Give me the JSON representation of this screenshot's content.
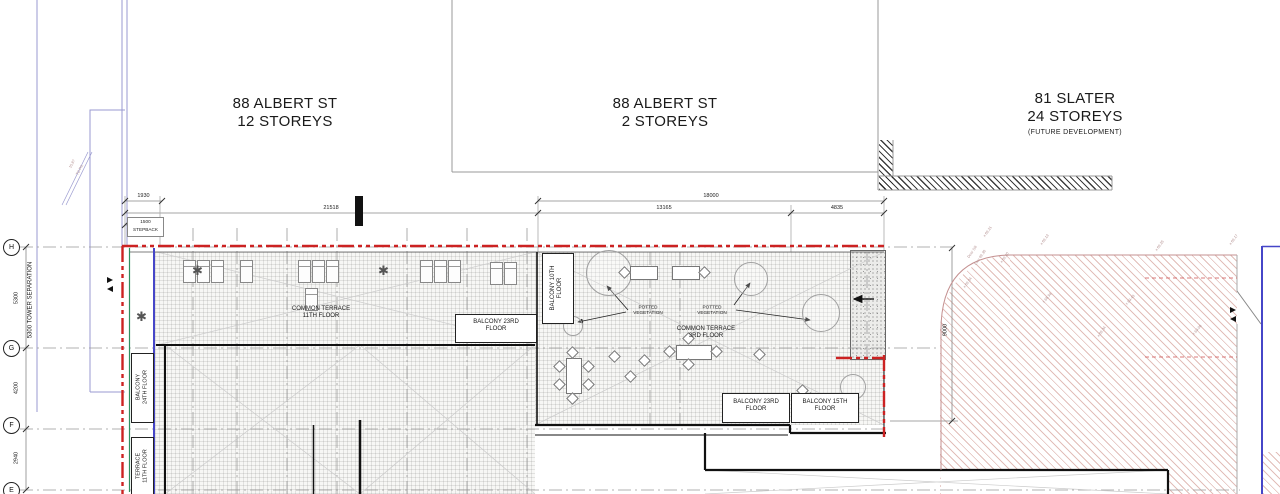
{
  "colors": {
    "red_boundary": "#cc2222",
    "green_line": "#2e9060",
    "blue_line": "#4646c8",
    "purple_line": "#9a9ad0",
    "hatch_pink": "#c49090"
  },
  "parcels": [
    {
      "title": "88 ALBERT ST",
      "subtitle": "12 STOREYS",
      "note": ""
    },
    {
      "title": "88 ALBERT ST",
      "subtitle": "2 STOREYS",
      "note": ""
    },
    {
      "title": "81 SLATER",
      "subtitle": "24 STOREYS",
      "note": "(FUTURE DEVELOPMENT)"
    }
  ],
  "grid_rows": [
    {
      "label": "H",
      "dim_below": "5300"
    },
    {
      "label": "G",
      "dim_below": "4200"
    },
    {
      "label": "F",
      "dim_below": "2940"
    },
    {
      "label": "E",
      "dim_below": ""
    }
  ],
  "dims": {
    "d1930": "1930",
    "d18000": "18000",
    "d21518": "21518",
    "d13165": "13165",
    "d4835": "4835",
    "stepback_value": "1500",
    "stepback_label": "STEPBACK",
    "d9000": "9000",
    "tower_sep": "5300 TOWER SEPARATION"
  },
  "areas": {
    "common_terrace_11": {
      "line1": "COMMON TERRACE",
      "line2": "11TH FLOOR"
    },
    "balcony_23_mid": {
      "line1": "BALCONY 23RD",
      "line2": "FLOOR"
    },
    "balcony_10": {
      "line1": "BALCONY 10TH",
      "line2": "FLOOR"
    },
    "common_terrace_3": {
      "line1": "COMMON TERRACE",
      "line2": "3RD FLOOR"
    },
    "balcony_23_low": {
      "line1": "BALCONY 23RD",
      "line2": "FLOOR"
    },
    "balcony_15": {
      "line1": "BALCONY 15TH",
      "line2": "FLOOR"
    },
    "balcony_24": {
      "line1": "BALCONY",
      "line2": "24TH FLOOR"
    },
    "terrace_11": {
      "line1": "TERRACE",
      "line2": "11TH FLOOR"
    },
    "potted_1": {
      "line1": "POTTED",
      "line2": "VEGETATION"
    },
    "potted_2": {
      "line1": "POTTED",
      "line2": "VEGETATION"
    }
  },
  "survey_marks": [
    {
      "text": "x 69.21",
      "x": 986,
      "y": 232,
      "r": -55
    },
    {
      "text": "x 69.13",
      "x": 1043,
      "y": 240,
      "r": -55
    },
    {
      "text": "Door Sill",
      "x": 970,
      "y": 253,
      "r": -55
    },
    {
      "text": "Elev 69.30",
      "x": 977,
      "y": 260,
      "r": -55
    },
    {
      "text": "x 69.20",
      "x": 1003,
      "y": 258,
      "r": -55
    },
    {
      "text": "x 69.04",
      "x": 966,
      "y": 283,
      "r": -55
    },
    {
      "text": "x 68.94",
      "x": 1045,
      "y": 298,
      "r": -50
    },
    {
      "text": "x 69.34",
      "x": 1100,
      "y": 332,
      "r": -55
    },
    {
      "text": "x 69.43",
      "x": 1128,
      "y": 300,
      "r": -50
    },
    {
      "text": "x 69.25",
      "x": 1158,
      "y": 246,
      "r": -55
    },
    {
      "text": "x 69.17",
      "x": 1232,
      "y": 240,
      "r": -55
    },
    {
      "text": "x 69.08",
      "x": 1195,
      "y": 330,
      "r": -50
    },
    {
      "text": "15.87",
      "x": 72,
      "y": 163,
      "r": -62
    },
    {
      "text": "TO P/L",
      "x": 79,
      "y": 170,
      "r": -62
    }
  ]
}
